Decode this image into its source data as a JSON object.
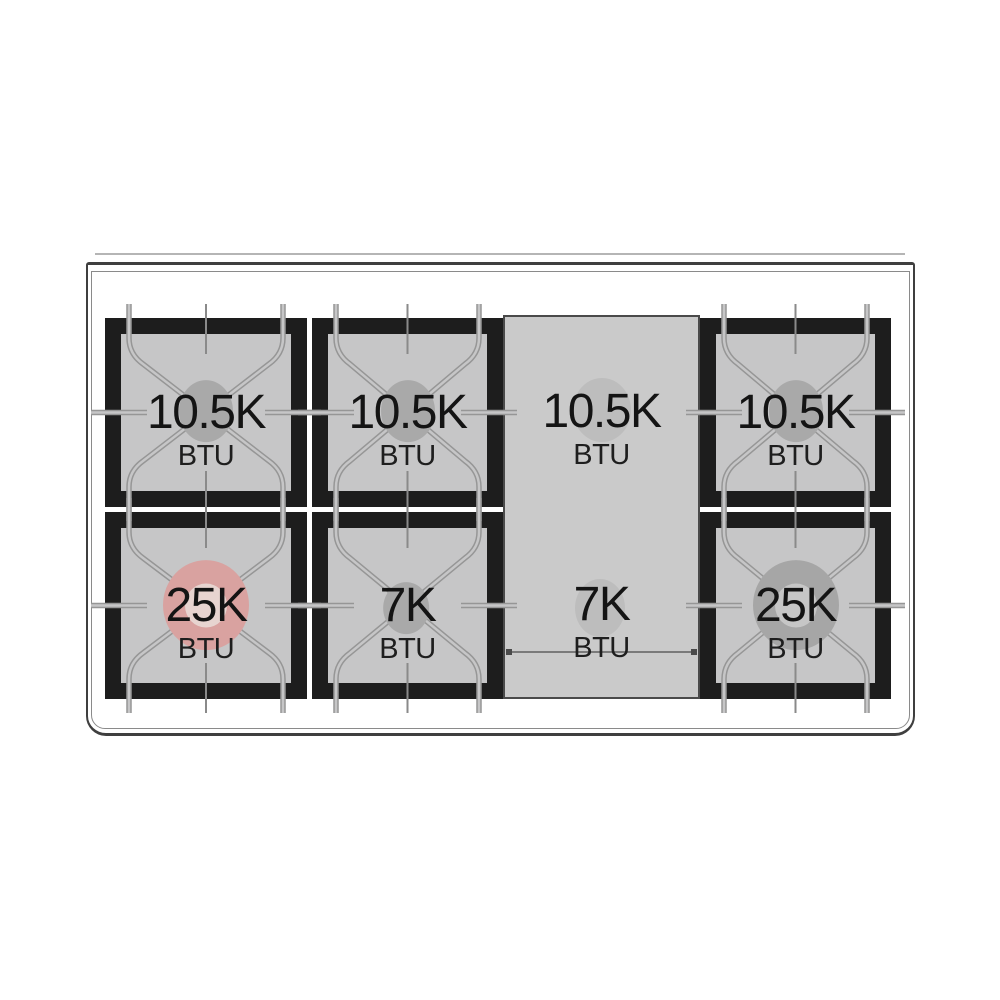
{
  "diagram": {
    "title": "gas-rangetop-burner-btu-diagram",
    "unit_label": "BTU",
    "burners": {
      "r1c1": {
        "power": "10.5K",
        "unit": "BTU",
        "type": "standard"
      },
      "r1c2": {
        "power": "10.5K",
        "unit": "BTU",
        "type": "standard"
      },
      "r1c3": {
        "power": "10.5K",
        "unit": "BTU",
        "type": "griddle-front"
      },
      "r1c4": {
        "power": "10.5K",
        "unit": "BTU",
        "type": "standard"
      },
      "r2c1": {
        "power": "25K",
        "unit": "BTU",
        "type": "dual-ring-highlighted"
      },
      "r2c2": {
        "power": "7K",
        "unit": "BTU",
        "type": "small"
      },
      "r2c3": {
        "power": "7K",
        "unit": "BTU",
        "type": "griddle-rear"
      },
      "r2c4": {
        "power": "25K",
        "unit": "BTU",
        "type": "dual-ring"
      }
    },
    "colors": {
      "grate_black": "#1d1d1d",
      "grate_surface": "#c6c6c7",
      "griddle_surface": "#cacaca",
      "burner_gray": "#a9a9a9",
      "highlight_burner": "#d9a2a0",
      "finger_line": "#969696"
    }
  }
}
